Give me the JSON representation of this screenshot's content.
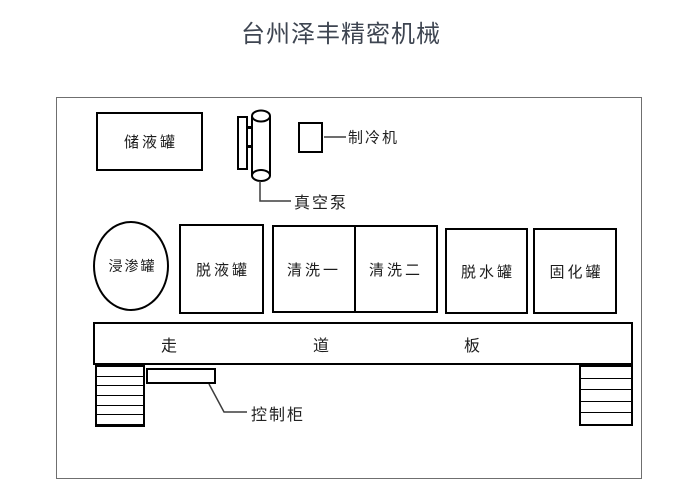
{
  "title": "台州泽丰精密机械",
  "diagram": {
    "tanks": {
      "storage": "储液罐",
      "impregnation": "浸渗罐",
      "drain": "脱液罐",
      "cleaning1": "清洗一",
      "cleaning2": "清洗二",
      "dewater": "脱水罐",
      "curing": "固化罐"
    },
    "labels": {
      "vacuum_pump": "真空泵",
      "chiller": "制冷机",
      "control_cabinet": "控制柜"
    },
    "walkway_chars": [
      "走",
      "道",
      "板"
    ],
    "colors": {
      "line": "#000000",
      "outer_border": "#6f6f6f",
      "leader": "#3d3d3d",
      "title_text": "#3e4551"
    }
  }
}
